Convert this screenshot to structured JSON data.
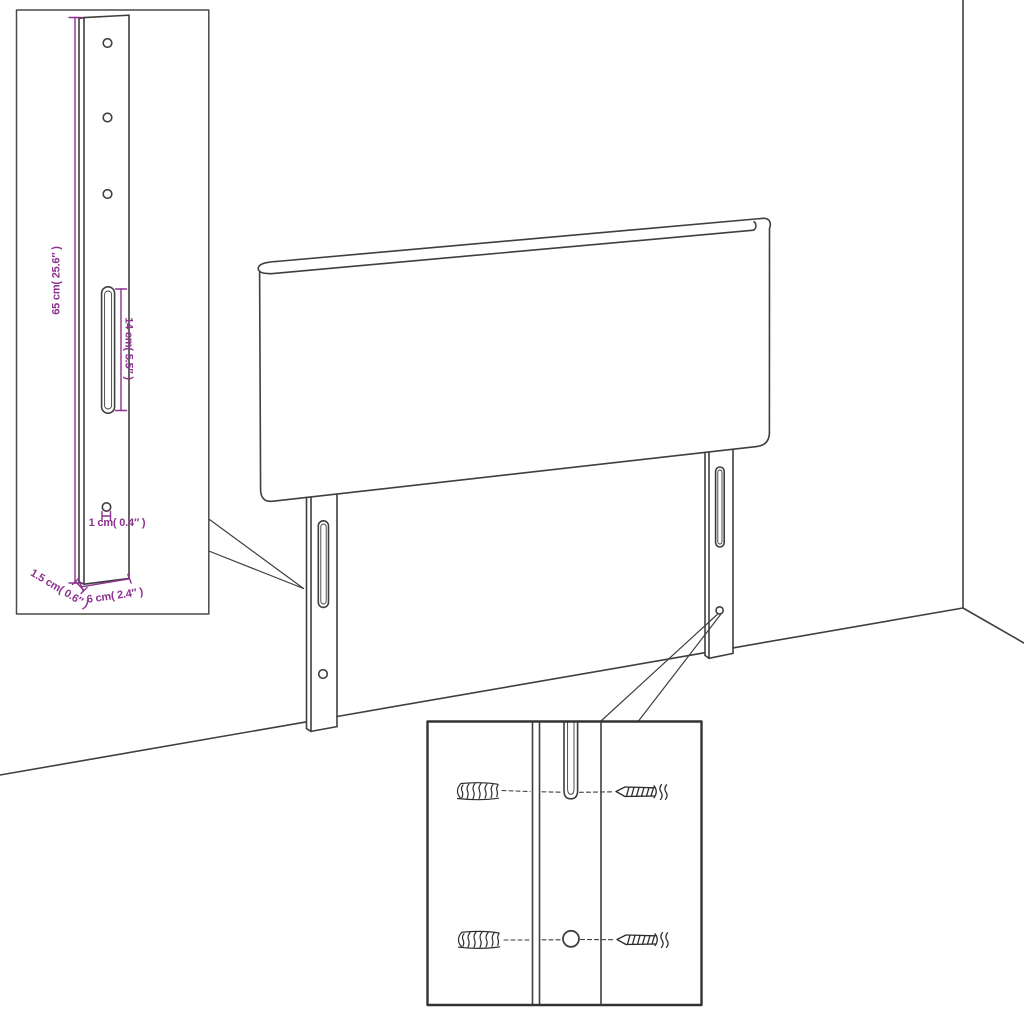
{
  "diagram": {
    "colors": {
      "background": "#ffffff",
      "line": "#3f3f3f",
      "dimension": "#8e3190"
    },
    "dimensions": {
      "height": "65 cm( 25.6″ )",
      "slot_length": "14 cm( 5.5″ )",
      "hole_diameter": "1 cm( 0.4″ )",
      "leg_width": "6 cm( 2.4″ )",
      "leg_thickness": "1.5 cm( 0.6″ )"
    }
  }
}
